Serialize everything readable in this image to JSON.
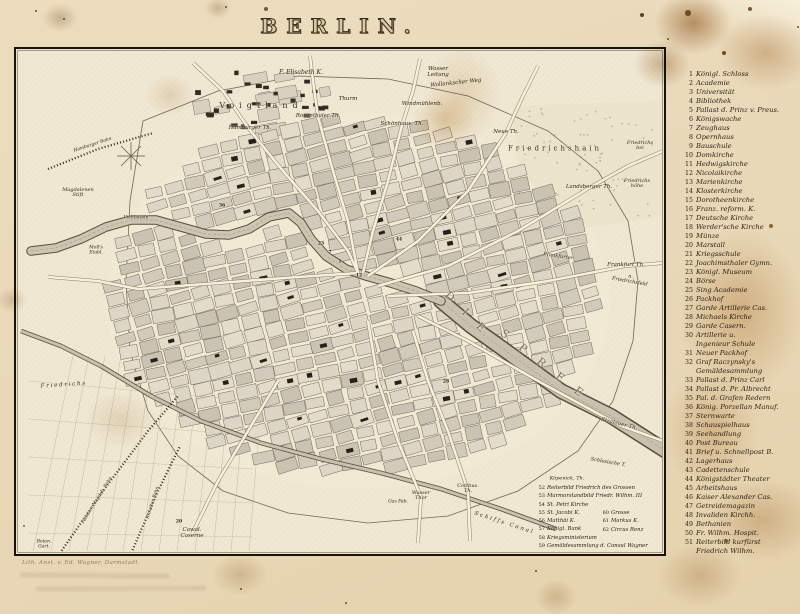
{
  "page": {
    "title": "BERLIN.",
    "imprint": "Lith. Anst. v. Ed. Wagner, Darmstadt."
  },
  "legend": {
    "items": [
      {
        "n": "1",
        "label": "Königl. Schloss"
      },
      {
        "n": "2",
        "label": "Academie"
      },
      {
        "n": "3",
        "label": "Universität"
      },
      {
        "n": "4",
        "label": "Bibliothek"
      },
      {
        "n": "5",
        "label": "Pallast d. Prinz v. Preus."
      },
      {
        "n": "6",
        "label": "Königswache"
      },
      {
        "n": "7",
        "label": "Zeughaus"
      },
      {
        "n": "8",
        "label": "Opernhaus"
      },
      {
        "n": "9",
        "label": "Bauschule"
      },
      {
        "n": "10",
        "label": "Domkirche"
      },
      {
        "n": "11",
        "label": "Hedwigskirche"
      },
      {
        "n": "12",
        "label": "Nicolaikirche"
      },
      {
        "n": "13",
        "label": "Marienkirche"
      },
      {
        "n": "14",
        "label": "Klosterkirche"
      },
      {
        "n": "15",
        "label": "Dorotheenkirche"
      },
      {
        "n": "16",
        "label": "Franz. reform. K."
      },
      {
        "n": "17",
        "label": "Deutsche Kirche"
      },
      {
        "n": "18",
        "label": "Werder'sche Kirche"
      },
      {
        "n": "19",
        "label": "Münze"
      },
      {
        "n": "20",
        "label": "Marstall"
      },
      {
        "n": "21",
        "label": "Kriegsschule"
      },
      {
        "n": "22",
        "label": "Joachimsthaler Gymn."
      },
      {
        "n": "23",
        "label": "Königl. Museum"
      },
      {
        "n": "24",
        "label": "Börse"
      },
      {
        "n": "25",
        "label": "Sing Academie"
      },
      {
        "n": "26",
        "label": "Packhof"
      },
      {
        "n": "27",
        "label": "Garde Artillerie Cas."
      },
      {
        "n": "28",
        "label": "Michaels Kirche"
      },
      {
        "n": "29",
        "label": "Garde Casern."
      },
      {
        "n": "30",
        "label": "Artillerie u.\nIngenieur Schule"
      },
      {
        "n": "31",
        "label": "Neuer Packhof"
      },
      {
        "n": "32",
        "label": "Graf Raczynsky's\nGemäldesammlung"
      },
      {
        "n": "33",
        "label": "Pallast d. Prinz Carl"
      },
      {
        "n": "34",
        "label": "Pallast d. Pr. Albrecht"
      },
      {
        "n": "35",
        "label": "Pal. d. Grafen Redern"
      },
      {
        "n": "36",
        "label": "König. Porzellan Manuf."
      },
      {
        "n": "37",
        "label": "Sternwarte"
      },
      {
        "n": "38",
        "label": "Schauspielhaus"
      },
      {
        "n": "39",
        "label": "Seehandlung"
      },
      {
        "n": "40",
        "label": "Post Bureau"
      },
      {
        "n": "41",
        "label": "Brief u. Schnellpost B."
      },
      {
        "n": "42",
        "label": "Lagerhaus"
      },
      {
        "n": "43",
        "label": "Cadettenschule"
      },
      {
        "n": "44",
        "label": "Königstädter Theater"
      },
      {
        "n": "45",
        "label": "Arbeitshaus"
      },
      {
        "n": "46",
        "label": "Kaiser Alexander Cas."
      },
      {
        "n": "47",
        "label": "Getreidemagazin"
      },
      {
        "n": "48",
        "label": "Invaliden Kirchh."
      },
      {
        "n": "49",
        "label": "Bethanien"
      },
      {
        "n": "50",
        "label": "Fr. Wilhm. Hospit."
      },
      {
        "n": "51",
        "label": "Reiterbild kurfürst\nFriedrich Wilhm."
      }
    ]
  },
  "map": {
    "inset": {
      "col1": [
        {
          "n": "52",
          "label": "Reiterbild Friedrich des Grossen"
        },
        {
          "n": "53",
          "label": "Marmorstandbild Friedr. Wilhm. III"
        },
        {
          "n": "54",
          "label": "St. Petri Kirche"
        },
        {
          "n": "55",
          "label": "St. Jacobi K."
        },
        {
          "n": "56",
          "label": "Matthäi K."
        },
        {
          "n": "57",
          "label": "Königl. Bank"
        },
        {
          "n": "58",
          "label": "Kriegsministerium"
        },
        {
          "n": "59",
          "label": "Gemäldesammlung d. Consul Wagner"
        }
      ],
      "col2": [
        {
          "n": "60",
          "label": "Grosse"
        },
        {
          "n": "61",
          "label": "Markus K."
        },
        {
          "n": "62",
          "label": "Circus Renz"
        }
      ]
    },
    "labels": [
      {
        "t": "F. Elisabeth K.",
        "x": 283,
        "y": 22,
        "s": 6
      },
      {
        "t": "Wollankscher Weg",
        "x": 438,
        "y": 33,
        "s": 5.5,
        "r": -6
      },
      {
        "t": "Thurm",
        "x": 330,
        "y": 49,
        "s": 5.5
      },
      {
        "t": "Wasser\nLeitung",
        "x": 420,
        "y": 22,
        "s": 5.5
      },
      {
        "t": "Windmühlenb.",
        "x": 404,
        "y": 54,
        "s": 5.5
      },
      {
        "t": "Voigtland",
        "x": 243,
        "y": 55,
        "s": 8,
        "k": "sp",
        "ls": 5
      },
      {
        "t": "Hamburger Th.",
        "x": 232,
        "y": 78,
        "s": 5.5
      },
      {
        "t": "Rosenthaler Th.",
        "x": 300,
        "y": 66,
        "s": 5.5
      },
      {
        "t": "Schönhaus. Th.",
        "x": 384,
        "y": 74,
        "s": 5.5
      },
      {
        "t": "Neue Th.",
        "x": 488,
        "y": 82,
        "s": 5.5
      },
      {
        "t": "Friedrichshain",
        "x": 537,
        "y": 98,
        "s": 7,
        "k": "sp",
        "ls": 3
      },
      {
        "t": "Friedrichs\nbei",
        "x": 622,
        "y": 95,
        "s": 5
      },
      {
        "t": "Friedrichs\nhöhe",
        "x": 619,
        "y": 133,
        "s": 5
      },
      {
        "t": "Landsberger Th.",
        "x": 571,
        "y": 137,
        "s": 5.5
      },
      {
        "t": "Frankfurter",
        "x": 540,
        "y": 206,
        "s": 5,
        "r": 8
      },
      {
        "t": "Frankfurt Th.",
        "x": 608,
        "y": 215,
        "s": 5.5
      },
      {
        "t": "n. Friedrichsfeld",
        "x": 612,
        "y": 229,
        "s": 5,
        "r": 10
      },
      {
        "t": "D I E",
        "x": 449,
        "y": 263,
        "s": 11,
        "k": "riv",
        "r": 45,
        "ls": 6
      },
      {
        "t": "S P R E E",
        "x": 526,
        "y": 314,
        "s": 11,
        "k": "riv",
        "r": 38,
        "ls": 6
      },
      {
        "t": "Stralauer Th.",
        "x": 601,
        "y": 374,
        "s": 5.5,
        "r": 14
      },
      {
        "t": "Schlesische T.",
        "x": 590,
        "y": 412,
        "s": 5,
        "r": 10
      },
      {
        "t": "Köpenick. Th.",
        "x": 549,
        "y": 428,
        "s": 5
      },
      {
        "t": "Cottbus.\nTh.",
        "x": 450,
        "y": 438,
        "s": 5
      },
      {
        "t": "Wasser\nThor",
        "x": 403,
        "y": 445,
        "s": 5
      },
      {
        "t": "Gas Fab.",
        "x": 380,
        "y": 452,
        "s": 4.5
      },
      {
        "t": "Schiffs Canal",
        "x": 486,
        "y": 473,
        "s": 5.5,
        "r": 18,
        "ls": 2
      },
      {
        "t": "Cawal.\nCaserne",
        "x": 174,
        "y": 483,
        "s": 5.5
      },
      {
        "t": "Botan.\nGart.",
        "x": 26,
        "y": 494,
        "s": 4.5
      },
      {
        "t": "Potsdam Magdeb. Bahn",
        "x": 80,
        "y": 450,
        "s": 4.5,
        "r": -58
      },
      {
        "t": "Anhalter Bahn",
        "x": 136,
        "y": 452,
        "s": 4.5,
        "r": -72
      },
      {
        "t": "Hamburger Bahn",
        "x": 75,
        "y": 95,
        "s": 4.5,
        "r": -18
      },
      {
        "t": "Magdalenen\nStift",
        "x": 60,
        "y": 142,
        "s": 5
      },
      {
        "t": "Moll's\nEtabl.",
        "x": 78,
        "y": 200,
        "s": 4.5
      },
      {
        "t": "Viehbassin",
        "x": 118,
        "y": 168,
        "s": 4.5
      },
      {
        "t": "F r i e d r i c h s",
        "x": 45,
        "y": 335,
        "s": 5.5,
        "r": -4
      },
      {
        "t": "1",
        "x": 322,
        "y": 212,
        "s": 4.5,
        "k": "num"
      },
      {
        "t": "7",
        "x": 312,
        "y": 203,
        "s": 4.5,
        "k": "num"
      },
      {
        "t": "12",
        "x": 341,
        "y": 226,
        "s": 4.5,
        "k": "num"
      },
      {
        "t": "23",
        "x": 303,
        "y": 194,
        "s": 4.5,
        "k": "num"
      },
      {
        "t": "28",
        "x": 428,
        "y": 332,
        "s": 4.5,
        "k": "num"
      },
      {
        "t": "44",
        "x": 381,
        "y": 190,
        "s": 4.5,
        "k": "num"
      },
      {
        "t": "36",
        "x": 204,
        "y": 156,
        "s": 4.5,
        "k": "num"
      },
      {
        "t": "20",
        "x": 161,
        "y": 472,
        "s": 4.5,
        "k": "num"
      }
    ]
  }
}
